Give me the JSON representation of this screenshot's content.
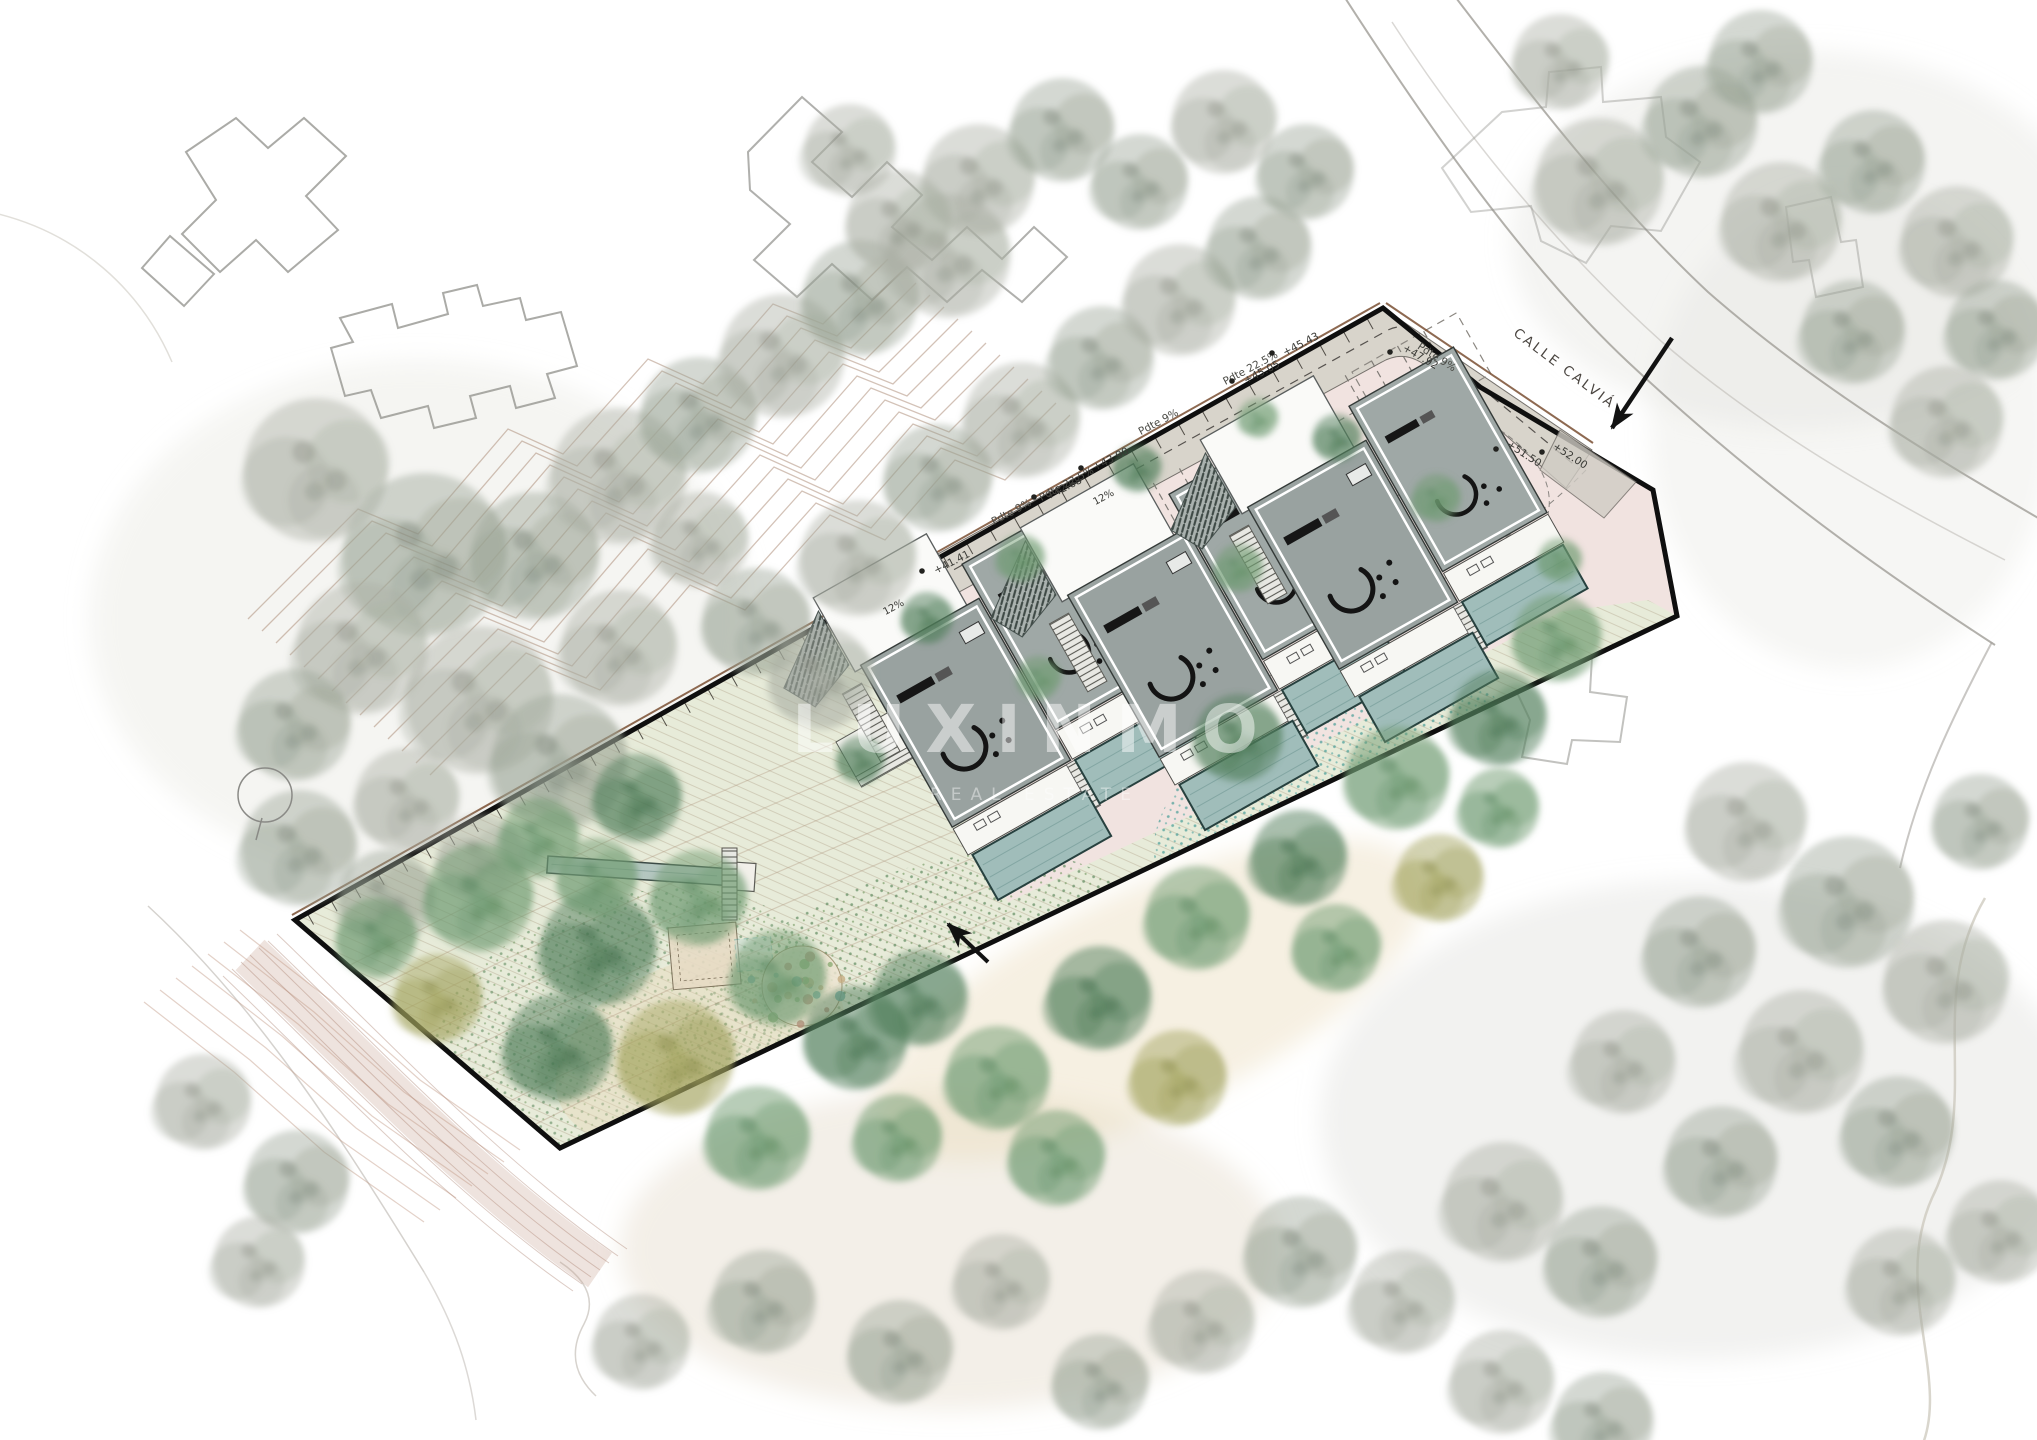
{
  "plan": {
    "street_name": "CALLE CALVIÁ",
    "watermark_brand": "LUXINMO",
    "watermark_tagline": "REAL ESTATE",
    "slope_label_9": "Pdte 9%",
    "slope_label_225": "Pdte 22.5%",
    "ramp_label_12": "12%",
    "elevations": {
      "e4505": "+45.05",
      "e4543": "+45.43",
      "e4268": "+42.68",
      "e4390": "+43.90",
      "e4792": "+47.92",
      "e4141": "+41.41",
      "e5150": "+51.50",
      "e5200": "+52.00"
    }
  }
}
